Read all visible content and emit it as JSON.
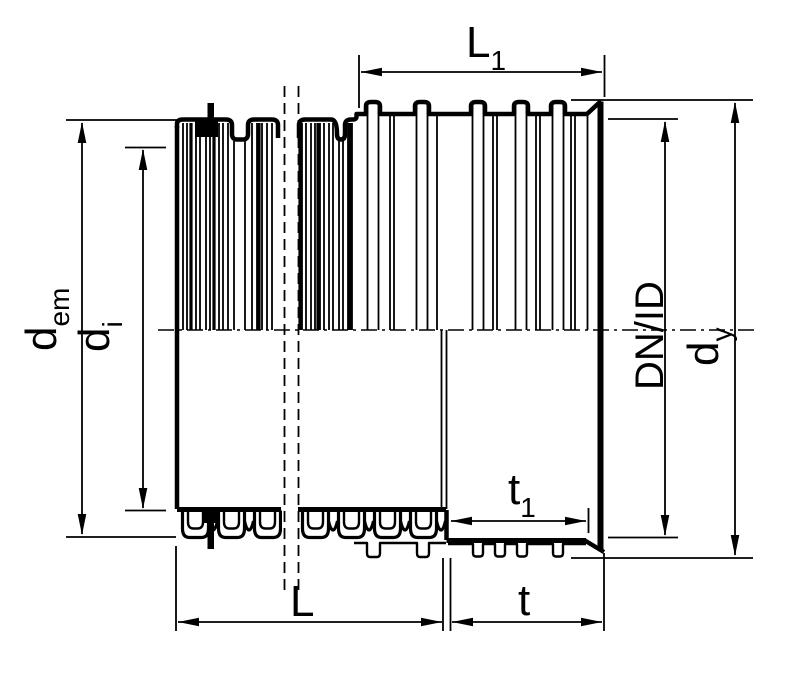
{
  "drawing": {
    "description": "corrugated-pipe-with-socket-section",
    "colors": {
      "line": "#000000",
      "background": "#ffffff"
    },
    "labels": {
      "L1": {
        "base": "L",
        "sub": "1"
      },
      "dem": {
        "base": "d",
        "sub": "em"
      },
      "di": {
        "base": "d",
        "sub": "i"
      },
      "DNID": {
        "text": "DN/ID"
      },
      "dy": {
        "base": "d",
        "sub": "y"
      },
      "t1": {
        "base": "t",
        "sub": "1"
      },
      "L": {
        "text": "L"
      },
      "t": {
        "text": "t"
      }
    }
  }
}
